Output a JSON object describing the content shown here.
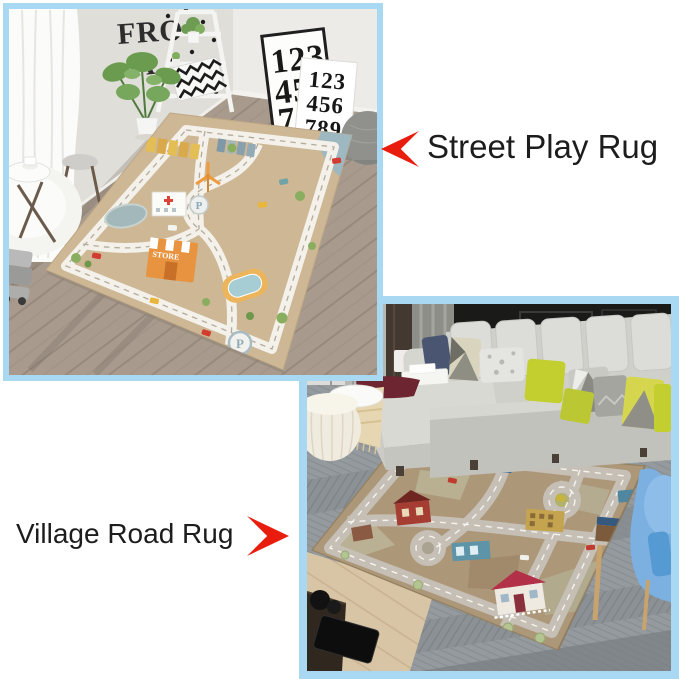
{
  "colors": {
    "canvas_bg": "#ffffff",
    "panel_border": "#a9d8f3",
    "arrow_red": "#e91d0e",
    "caption_text": "#1d1d1d",
    "street_rug_base": "#cdb795",
    "village_rug_base": "#ad9779",
    "sofa_gray": "#d0d0cb",
    "pillow_chartreuse": "#c3cf2e"
  },
  "captions": {
    "street": "Street Play Rug",
    "village": "Village Road Rug"
  },
  "street_panel": {
    "wall_letters": {
      "top": "FRO",
      "bottom": "A"
    },
    "poster_large": {
      "row1": "123",
      "row2": "45",
      "row3": "78"
    },
    "poster_small": {
      "row1": "123",
      "row2": "456",
      "row3": "789"
    },
    "rug": {
      "store_sign": "STORE",
      "helipad_letter": "P",
      "parking_letter": "P"
    }
  }
}
